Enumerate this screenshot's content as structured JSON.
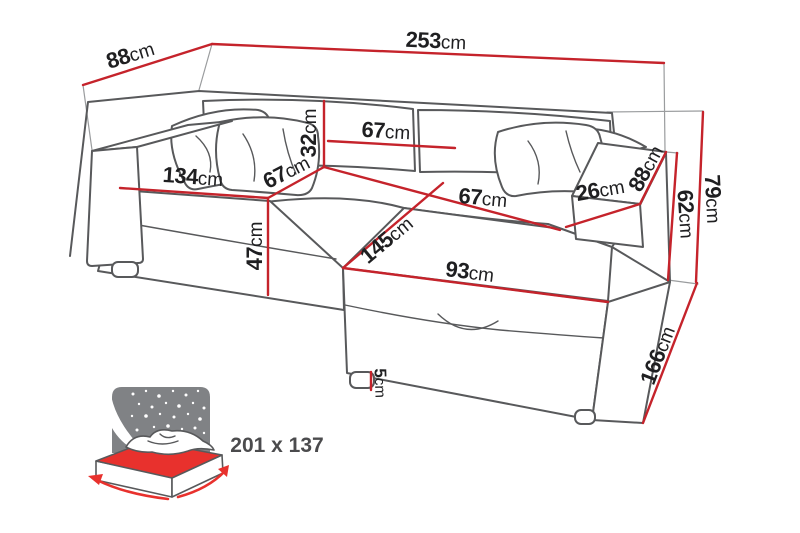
{
  "diagram": {
    "title": "corner-sofa-bed-dimension-diagram",
    "unit": "cm",
    "colors": {
      "dimension_red": "#c5232b",
      "outline_gray": "#58595b",
      "bed_icon_gray": "#808285",
      "bed_icon_red": "#e8312d",
      "label_text": "#1f1f21"
    }
  },
  "dims": {
    "w253": {
      "v": "253",
      "u": "cm",
      "meaning": "total width"
    },
    "d88": {
      "v": "88",
      "u": "cm",
      "meaning": "total depth"
    },
    "h32": {
      "v": "32",
      "u": "cm",
      "meaning": "backrest height"
    },
    "w67back": {
      "v": "67",
      "u": "cm",
      "meaning": "backrest section width"
    },
    "w134": {
      "v": "134",
      "u": "cm",
      "meaning": "left seat width"
    },
    "d67seat": {
      "v": "67",
      "u": "cm",
      "meaning": "seat depth"
    },
    "h47": {
      "v": "47",
      "u": "cm",
      "meaning": "seat height"
    },
    "l145": {
      "v": "145",
      "u": "cm",
      "meaning": "chaise length"
    },
    "w67chaise": {
      "v": "67",
      "u": "cm",
      "meaning": "chaise width at back"
    },
    "w93": {
      "v": "93",
      "u": "cm",
      "meaning": "chaise front width"
    },
    "w26": {
      "v": "26",
      "u": "cm",
      "meaning": "armrest width"
    },
    "d88arm": {
      "v": "88",
      "u": "cm",
      "meaning": "armrest depth"
    },
    "h62": {
      "v": "62",
      "u": "cm",
      "meaning": "arm height"
    },
    "h79": {
      "v": "79",
      "u": "cm",
      "meaning": "total height"
    },
    "l166": {
      "v": "166",
      "u": "cm",
      "meaning": "chaise side length"
    },
    "h5": {
      "v": "5",
      "u": "cm",
      "meaning": "leg height"
    }
  },
  "bed": {
    "size": "201 x 137",
    "meaning": "sleeping area dimensions"
  }
}
